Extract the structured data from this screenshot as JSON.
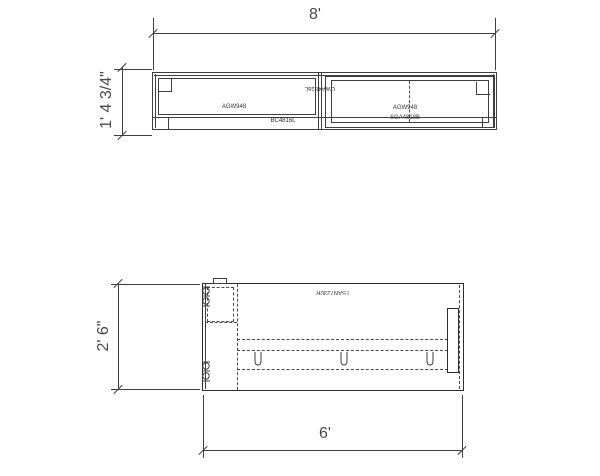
{
  "drawing": {
    "colors": {
      "line": "#3f3f3f",
      "dim_text": "#4a4a4a",
      "background": "#ffffff"
    },
    "elevation": {
      "width_dim": "8'",
      "height_dim": "1' 4 3/4\"",
      "left_upper_code": "AGW948",
      "left_lower_code": "BC4816L",
      "center_code": "CWA4816L",
      "right_upper_code": "AGW948",
      "right_lower_code": "SGA4818B"
    },
    "plan": {
      "width_dim": "6'",
      "depth_dim": "2' 6\"",
      "desk_code": "TSAN7230R"
    }
  }
}
